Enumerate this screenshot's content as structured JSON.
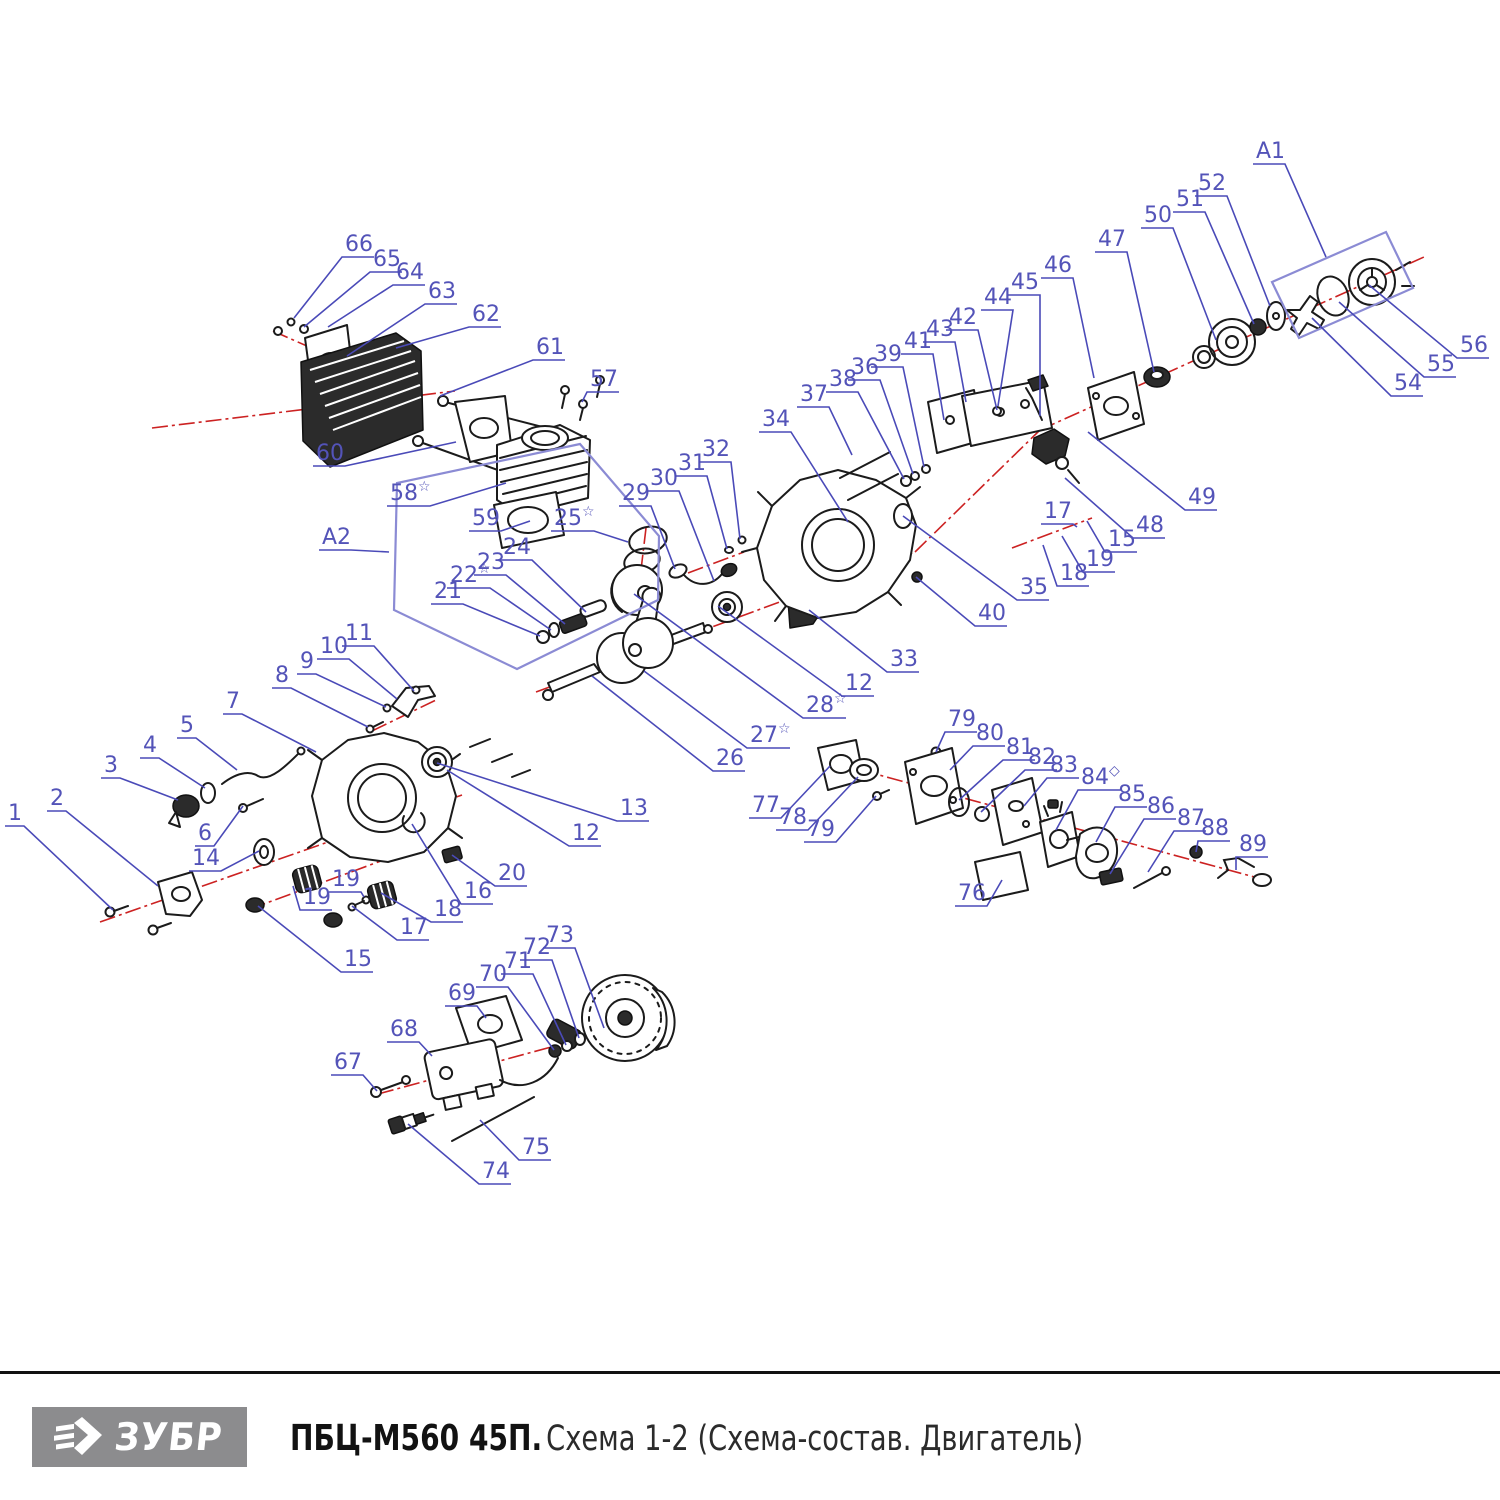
{
  "footer": {
    "brand": "ЗУБР",
    "title_bold": "ПБЦ-М560 45П.",
    "title_rest": " Схема 1-2 (Схема-состав. Двигатель)"
  },
  "colors": {
    "label": "#5353b8",
    "leader": "#4a4ab8",
    "group_box": "#8b8bd4",
    "axis_red": "#cc2222",
    "part_ink": "#1b1b1b",
    "brand_bg": "#8c8c8e"
  },
  "diagram": {
    "group_boxes": [
      "A1",
      "A2"
    ],
    "labels": [
      {
        "t": "1",
        "x": 8,
        "y": 800,
        "tx": 113,
        "ty": 910
      },
      {
        "t": "2",
        "x": 50,
        "y": 785,
        "tx": 158,
        "ty": 886
      },
      {
        "t": "3",
        "x": 104,
        "y": 752,
        "tx": 178,
        "ty": 800
      },
      {
        "t": "4",
        "x": 143,
        "y": 732,
        "tx": 205,
        "ty": 788
      },
      {
        "t": "5",
        "x": 180,
        "y": 712,
        "tx": 237,
        "ty": 770
      },
      {
        "t": "6",
        "x": 198,
        "y": 820,
        "tx": 243,
        "ty": 806
      },
      {
        "t": "7",
        "x": 226,
        "y": 688,
        "tx": 316,
        "ty": 752
      },
      {
        "t": "8",
        "x": 275,
        "y": 662,
        "tx": 368,
        "ty": 727
      },
      {
        "t": "9",
        "x": 300,
        "y": 648,
        "tx": 386,
        "ty": 707
      },
      {
        "t": "10",
        "x": 320,
        "y": 633,
        "tx": 397,
        "ty": 699
      },
      {
        "t": "11",
        "x": 345,
        "y": 620,
        "tx": 414,
        "ty": 691
      },
      {
        "t": "12",
        "x": 572,
        "y": 820,
        "tx": 447,
        "ty": 770
      },
      {
        "t": "13",
        "x": 620,
        "y": 795,
        "tx": 437,
        "ty": 763
      },
      {
        "t": "14",
        "x": 192,
        "y": 845,
        "tx": 259,
        "ty": 851
      },
      {
        "t": "15",
        "x": 344,
        "y": 946,
        "tx": 258,
        "ty": 906
      },
      {
        "t": "16",
        "x": 464,
        "y": 878,
        "tx": 412,
        "ty": 824
      },
      {
        "t": "17",
        "x": 400,
        "y": 914,
        "tx": 352,
        "ty": 906
      },
      {
        "t": "18",
        "x": 434,
        "y": 896,
        "tx": 381,
        "ty": 893
      },
      {
        "t": "19",
        "x": 332,
        "y": 866,
        "tx": 364,
        "ty": 897
      },
      {
        "t": "19",
        "x": 303,
        "y": 884,
        "tx": 293,
        "ty": 886
      },
      {
        "t": "20",
        "x": 498,
        "y": 860,
        "tx": 452,
        "ty": 855
      },
      {
        "t": "21",
        "x": 434,
        "y": 578,
        "tx": 540,
        "ty": 636
      },
      {
        "t": "22",
        "s": "☆",
        "x": 450,
        "y": 562,
        "tx": 551,
        "ty": 630
      },
      {
        "t": "23",
        "x": 477,
        "y": 549,
        "tx": 565,
        "ty": 624
      },
      {
        "t": "24",
        "x": 503,
        "y": 534,
        "tx": 586,
        "ty": 612
      },
      {
        "t": "25",
        "s": "☆",
        "x": 554,
        "y": 505,
        "tx": 628,
        "ty": 542
      },
      {
        "t": "26",
        "x": 716,
        "y": 745,
        "tx": 592,
        "ty": 676
      },
      {
        "t": "27",
        "s": "☆",
        "x": 750,
        "y": 722,
        "tx": 644,
        "ty": 671
      },
      {
        "t": "28",
        "s": "☆",
        "x": 806,
        "y": 692,
        "tx": 634,
        "ty": 594
      },
      {
        "t": "12",
        "x": 845,
        "y": 670,
        "tx": 718,
        "ty": 606
      },
      {
        "t": "29",
        "x": 622,
        "y": 480,
        "tx": 675,
        "ty": 569
      },
      {
        "t": "30",
        "x": 650,
        "y": 465,
        "tx": 714,
        "ty": 581
      },
      {
        "t": "31",
        "x": 678,
        "y": 450,
        "tx": 727,
        "ty": 549
      },
      {
        "t": "32",
        "x": 702,
        "y": 436,
        "tx": 740,
        "ty": 539
      },
      {
        "t": "33",
        "x": 890,
        "y": 646,
        "tx": 809,
        "ty": 610
      },
      {
        "t": "34",
        "x": 762,
        "y": 406,
        "tx": 848,
        "ty": 522
      },
      {
        "t": "35",
        "x": 1020,
        "y": 574,
        "tx": 903,
        "ty": 516
      },
      {
        "t": "36",
        "x": 851,
        "y": 354,
        "tx": 913,
        "ty": 474
      },
      {
        "t": "37",
        "x": 800,
        "y": 381,
        "tx": 852,
        "ty": 455
      },
      {
        "t": "38",
        "x": 829,
        "y": 366,
        "tx": 904,
        "ty": 479
      },
      {
        "t": "39",
        "x": 874,
        "y": 341,
        "tx": 924,
        "ty": 467
      },
      {
        "t": "40",
        "x": 978,
        "y": 600,
        "tx": 916,
        "ty": 577
      },
      {
        "t": "41",
        "x": 904,
        "y": 328,
        "tx": 944,
        "ty": 420
      },
      {
        "t": "42",
        "x": 949,
        "y": 304,
        "tx": 997,
        "ty": 410
      },
      {
        "t": "43",
        "x": 926,
        "y": 316,
        "tx": 966,
        "ty": 402
      },
      {
        "t": "44",
        "x": 984,
        "y": 284,
        "tx": 998,
        "ty": 406
      },
      {
        "t": "45",
        "x": 1011,
        "y": 269,
        "tx": 1040,
        "ty": 416
      },
      {
        "t": "46",
        "x": 1044,
        "y": 252,
        "tx": 1094,
        "ty": 378
      },
      {
        "t": "47",
        "x": 1098,
        "y": 226,
        "tx": 1154,
        "ty": 372
      },
      {
        "t": "48",
        "x": 1136,
        "y": 512,
        "tx": 1065,
        "ty": 478
      },
      {
        "t": "49",
        "x": 1188,
        "y": 484,
        "tx": 1088,
        "ty": 432
      },
      {
        "t": "50",
        "x": 1144,
        "y": 202,
        "tx": 1216,
        "ty": 340
      },
      {
        "t": "51",
        "x": 1176,
        "y": 186,
        "tx": 1254,
        "ty": 324
      },
      {
        "t": "52",
        "x": 1198,
        "y": 170,
        "tx": 1270,
        "ty": 306
      },
      {
        "t": "54",
        "x": 1394,
        "y": 370,
        "tx": 1312,
        "ty": 318
      },
      {
        "t": "55",
        "x": 1427,
        "y": 351,
        "tx": 1339,
        "ty": 302
      },
      {
        "t": "56",
        "x": 1460,
        "y": 332,
        "tx": 1369,
        "ty": 285
      },
      {
        "t": "15",
        "x": 1108,
        "y": 526,
        "tx": 1087,
        "ty": 521
      },
      {
        "t": "17",
        "x": 1044,
        "y": 498,
        "tx": 1077,
        "ty": 527
      },
      {
        "t": "18",
        "x": 1060,
        "y": 560,
        "tx": 1043,
        "ty": 545
      },
      {
        "t": "19",
        "x": 1086,
        "y": 546,
        "tx": 1062,
        "ty": 536
      },
      {
        "t": "57",
        "x": 590,
        "y": 366,
        "tx": 582,
        "ty": 402
      },
      {
        "t": "58",
        "s": "☆",
        "x": 390,
        "y": 480,
        "tx": 506,
        "ty": 483
      },
      {
        "t": "59",
        "x": 472,
        "y": 505,
        "tx": 530,
        "ty": 521
      },
      {
        "t": "60",
        "x": 316,
        "y": 440,
        "tx": 456,
        "ty": 442
      },
      {
        "t": "61",
        "x": 536,
        "y": 334,
        "tx": 440,
        "ty": 396
      },
      {
        "t": "62",
        "x": 472,
        "y": 301,
        "tx": 396,
        "ty": 348
      },
      {
        "t": "63",
        "x": 428,
        "y": 278,
        "tx": 347,
        "ty": 356
      },
      {
        "t": "64",
        "x": 396,
        "y": 259,
        "tx": 328,
        "ty": 327
      },
      {
        "t": "65",
        "x": 373,
        "y": 246,
        "tx": 304,
        "ty": 327
      },
      {
        "t": "66",
        "x": 345,
        "y": 231,
        "tx": 294,
        "ty": 318
      },
      {
        "t": "67",
        "x": 334,
        "y": 1049,
        "tx": 377,
        "ty": 1091
      },
      {
        "t": "68",
        "x": 390,
        "y": 1016,
        "tx": 432,
        "ty": 1056
      },
      {
        "t": "69",
        "x": 448,
        "y": 980,
        "tx": 486,
        "ty": 1018
      },
      {
        "t": "70",
        "x": 479,
        "y": 961,
        "tx": 554,
        "ty": 1050
      },
      {
        "t": "71",
        "x": 504,
        "y": 948,
        "tx": 566,
        "ty": 1045
      },
      {
        "t": "72",
        "x": 523,
        "y": 934,
        "tx": 579,
        "ty": 1038
      },
      {
        "t": "73",
        "x": 546,
        "y": 922,
        "tx": 604,
        "ty": 1028
      },
      {
        "t": "74",
        "x": 482,
        "y": 1158,
        "tx": 408,
        "ty": 1124
      },
      {
        "t": "75",
        "x": 522,
        "y": 1134,
        "tx": 480,
        "ty": 1120
      },
      {
        "t": "76",
        "x": 958,
        "y": 880,
        "tx": 1002,
        "ty": 880
      },
      {
        "t": "77",
        "x": 752,
        "y": 792,
        "tx": 830,
        "ty": 766
      },
      {
        "t": "78",
        "x": 779,
        "y": 804,
        "tx": 858,
        "ty": 777
      },
      {
        "t": "79",
        "x": 807,
        "y": 816,
        "tx": 876,
        "ty": 796
      },
      {
        "t": "79",
        "x": 948,
        "y": 706,
        "tx": 936,
        "ty": 752
      },
      {
        "t": "80",
        "x": 976,
        "y": 720,
        "tx": 950,
        "ty": 770
      },
      {
        "t": "81",
        "x": 1006,
        "y": 734,
        "tx": 959,
        "ty": 800
      },
      {
        "t": "82",
        "x": 1028,
        "y": 744,
        "tx": 981,
        "ty": 812
      },
      {
        "t": "83",
        "x": 1050,
        "y": 752,
        "tx": 1024,
        "ty": 806
      },
      {
        "t": "84",
        "s": "◇",
        "x": 1081,
        "y": 764,
        "tx": 1056,
        "ty": 830
      },
      {
        "t": "85",
        "x": 1118,
        "y": 781,
        "tx": 1096,
        "ty": 842
      },
      {
        "t": "86",
        "x": 1147,
        "y": 793,
        "tx": 1110,
        "ty": 874
      },
      {
        "t": "87",
        "x": 1177,
        "y": 805,
        "tx": 1148,
        "ty": 872
      },
      {
        "t": "88",
        "x": 1201,
        "y": 815,
        "tx": 1196,
        "ty": 852
      },
      {
        "t": "89",
        "x": 1239,
        "y": 831,
        "tx": 1236,
        "ty": 870
      },
      {
        "t": "A1",
        "x": 1256,
        "y": 138,
        "tx": 1326,
        "ty": 257
      },
      {
        "t": "A2",
        "x": 322,
        "y": 524,
        "tx": 389,
        "ty": 552
      }
    ]
  }
}
